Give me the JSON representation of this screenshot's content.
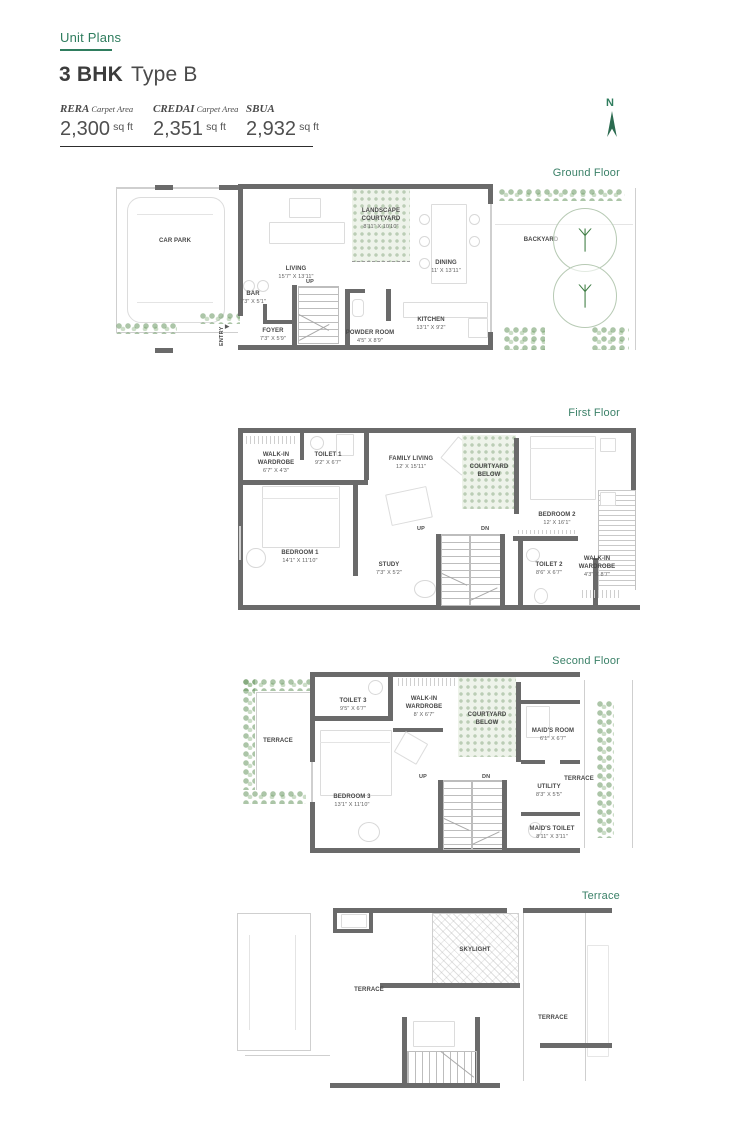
{
  "page": {
    "eyebrow": "Unit Plans",
    "title_bold": "3 BHK",
    "title_light": "Type B",
    "compass_label": "N"
  },
  "colors": {
    "accent_green": "#3b8168",
    "wall_gray": "#6a6a6a",
    "vegetation_green": "#6f9e6f"
  },
  "icons": {
    "tree": "ᛉ",
    "entry_arrow": "▶"
  },
  "stats": [
    {
      "label_main": "RERA",
      "label_sub": "Carpet Area",
      "value": "2,300",
      "unit": "sq ft"
    },
    {
      "label_main": "CREDAI",
      "label_sub": "Carpet Area",
      "value": "2,351",
      "unit": "sq ft"
    },
    {
      "label_main": "SBUA",
      "label_sub": "",
      "value": "2,932",
      "unit": "sq ft"
    }
  ],
  "floors": {
    "ground": {
      "label": "Ground Floor",
      "rooms": {
        "car_park": {
          "name": "CAR PARK"
        },
        "living": {
          "name": "LIVING",
          "dims": "15'7\" X 13'11\""
        },
        "bar": {
          "name": "BAR",
          "dims": "7'3\" X 5'1\""
        },
        "foyer": {
          "name": "FOYER",
          "dims": "7'3\" X 5'9\""
        },
        "powder_room": {
          "name": "POWDER ROOM",
          "dims": "4'5\" X 8'9\""
        },
        "landscape_courtyard": {
          "name": "LANDSCAPE COURTYARD",
          "dims": "8'11\" X 10'10\""
        },
        "dining": {
          "name": "DINING",
          "dims": "11' X 13'11\""
        },
        "kitchen": {
          "name": "KITCHEN",
          "dims": "13'1\" X 9'2\""
        },
        "backyard": {
          "name": "BACKYARD"
        },
        "up": "UP",
        "entry": "ENTRY"
      }
    },
    "first": {
      "label": "First Floor",
      "rooms": {
        "walk_in_wardrobe_1": {
          "name": "WALK-IN WARDROBE",
          "dims": "6'7\" X 4'3\""
        },
        "toilet_1": {
          "name": "TOILET 1",
          "dims": "9'2\" X 6'7\""
        },
        "family_living": {
          "name": "FAMILY LIVING",
          "dims": "12' X 15'11\""
        },
        "courtyard_below": {
          "name": "COURTYARD BELOW"
        },
        "bedroom_2": {
          "name": "BEDROOM 2",
          "dims": "12' X 16'1\""
        },
        "bedroom_1": {
          "name": "BEDROOM 1",
          "dims": "14'1\" X 11'10\""
        },
        "study": {
          "name": "STUDY",
          "dims": "7'3\" X 5'2\""
        },
        "toilet_2": {
          "name": "TOILET 2",
          "dims": "8'6\" X 6'7\""
        },
        "walk_in_wardrobe_2": {
          "name": "WALK-IN WARDROBE",
          "dims": "4'3\" X 8'7\""
        },
        "up": "UP",
        "dn": "DN"
      }
    },
    "second": {
      "label": "Second Floor",
      "rooms": {
        "terrace_left": {
          "name": "TERRACE"
        },
        "toilet_3": {
          "name": "TOILET 3",
          "dims": "9'5\" X 6'7\""
        },
        "walk_in_wardrobe_3": {
          "name": "WALK-IN WARDROBE",
          "dims": "8' X 6'7\""
        },
        "courtyard_below": {
          "name": "COURTYARD BELOW"
        },
        "maids_room": {
          "name": "MAID'S ROOM",
          "dims": "6'1\" X 6'7\""
        },
        "bedroom_3": {
          "name": "BEDROOM 3",
          "dims": "13'1\" X 11'10\""
        },
        "utility": {
          "name": "UTILITY",
          "dims": "8'3\" X 5'5\""
        },
        "maids_toilet": {
          "name": "MAID'S TOILET",
          "dims": "8'11\" X 3'11\""
        },
        "terrace_right": {
          "name": "TERRACE"
        },
        "up": "UP",
        "dn": "DN"
      }
    },
    "terrace": {
      "label": "Terrace",
      "rooms": {
        "terrace_main": {
          "name": "TERRACE"
        },
        "skylight": {
          "name": "SKYLIGHT"
        },
        "terrace_right": {
          "name": "TERRACE"
        }
      }
    }
  }
}
